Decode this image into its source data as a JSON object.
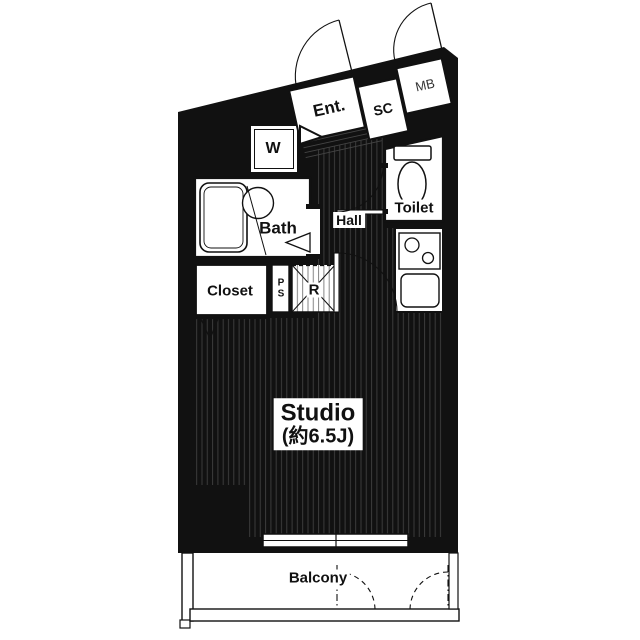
{
  "colors": {
    "wall": "#111111",
    "floor_stripe": "#3f3f3f",
    "background": "#ffffff",
    "text": "#111111"
  },
  "rooms": {
    "entrance": "Ent.",
    "shoe_cupboard": "SC",
    "meter_box": "MB",
    "washer": "W",
    "bath": "Bath",
    "hall": "Hall",
    "toilet": "Toilet",
    "closet": "Closet",
    "pipe_space": "P\nS",
    "refrigerator": "R",
    "studio_name": "Studio",
    "studio_size": "(約6.5J)",
    "balcony": "Balcony"
  }
}
